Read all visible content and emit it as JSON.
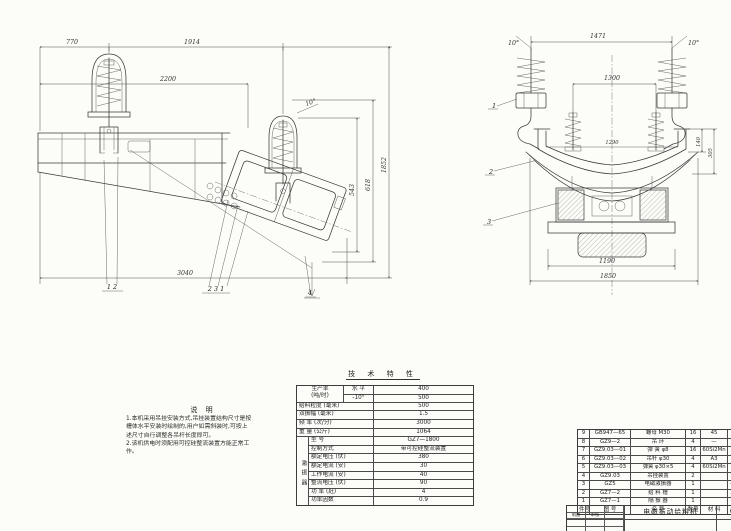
{
  "drawing": {
    "left_view": {
      "dims": {
        "top1": "770",
        "top2": "1914",
        "mid": "2200",
        "bottom": "3040",
        "h1": "543",
        "h2": "618",
        "h3": "1852",
        "angle": "10°"
      },
      "callouts": {
        "c1": "1  2",
        "c2": "2  3  1",
        "c3": "4"
      }
    },
    "right_view": {
      "dims": {
        "top": "1471",
        "angle_left": "10°",
        "angle_right": "10°",
        "inner": "1300",
        "trough": "1290",
        "side1": "140",
        "side2": "305",
        "base": "1190",
        "overall": "1850"
      },
      "callouts": {
        "p1": "1",
        "p2": "2",
        "p3": "3"
      }
    }
  },
  "notes": {
    "title": "说  明",
    "lines": [
      "1.本机采用吊挂安装方式,吊挂装置结构尺寸是按",
      "槽体水平安装时绘制的,用户如需斜装时,可按上",
      "述尺寸自行调整各吊杆长度即可。",
      "2.该机供电时须配用可控硅整流装置方能正常工",
      "作。"
    ]
  },
  "spec_table": {
    "title": "技 术 特 性",
    "prod": {
      "label_top": "生产率",
      "label_bottom": "(吨/时)",
      "rows": [
        [
          "水 平",
          "400"
        ],
        [
          "-10°",
          "500"
        ]
      ]
    },
    "rows": [
      [
        "给料粒度 (毫米)",
        "500"
      ],
      [
        "双振幅 (毫米)",
        "1.5"
      ],
      [
        "频 率 (次/分)",
        "3000"
      ],
      [
        "重 量 (公斤)",
        "1064"
      ]
    ],
    "exciter": {
      "group": "激振器",
      "rows": [
        [
          "型  号",
          "GZ7—1800"
        ],
        [
          "控制方式",
          "带可控硅整流装置"
        ],
        [
          "额定电压 (伏)",
          "380"
        ],
        [
          "额定电流 (安)",
          "30"
        ],
        [
          "工作电流 (安)",
          "40"
        ],
        [
          "整流电压 (伏)",
          "90"
        ],
        [
          "功 率 (瓩)",
          "4"
        ],
        [
          "功率因数",
          "0.9"
        ]
      ]
    }
  },
  "parts_table": {
    "header_rows": [
      [
        "件号",
        "图  号",
        "名    称",
        "数量",
        "材 料",
        "单重",
        "总重",
        "备注"
      ]
    ],
    "rows": [
      [
        "9",
        "GB947—65",
        "螺母 M30",
        "16",
        "45",
        "",
        "",
        ""
      ],
      [
        "8",
        "GZ9—2",
        "吊 环",
        "4",
        "—",
        "",
        "",
        ""
      ],
      [
        "7",
        "GZ9.03—01",
        "弹 簧 φ8",
        "16",
        "60Si2Mn",
        "0.5",
        "8",
        ""
      ],
      [
        "6",
        "GZ9.03—02",
        "吊杆 φ30",
        "4",
        "A3",
        "2.4",
        "9.6",
        ""
      ],
      [
        "5",
        "GZ9.03—03",
        "弹簧 φ30×5",
        "4",
        "60Si2Mn",
        "1.5",
        "6",
        ""
      ],
      [
        "4",
        "GZ9.03",
        "吊挂装置",
        "2",
        "",
        "",
        "",
        "组"
      ],
      [
        "3",
        "GZ5",
        "电磁激振器",
        "1",
        "",
        "475",
        "475",
        ""
      ],
      [
        "2",
        "GZ7—2",
        "给 料 槽",
        "1",
        "",
        "399",
        "399",
        ""
      ],
      [
        "1",
        "GZ7—1",
        "隔 振 器",
        "1",
        "",
        "31",
        "31",
        ""
      ]
    ]
  },
  "title_block": {
    "product": "电磁振动给料机",
    "model": "GZ7 型",
    "sign1": "制图",
    "sign2": "审核"
  }
}
